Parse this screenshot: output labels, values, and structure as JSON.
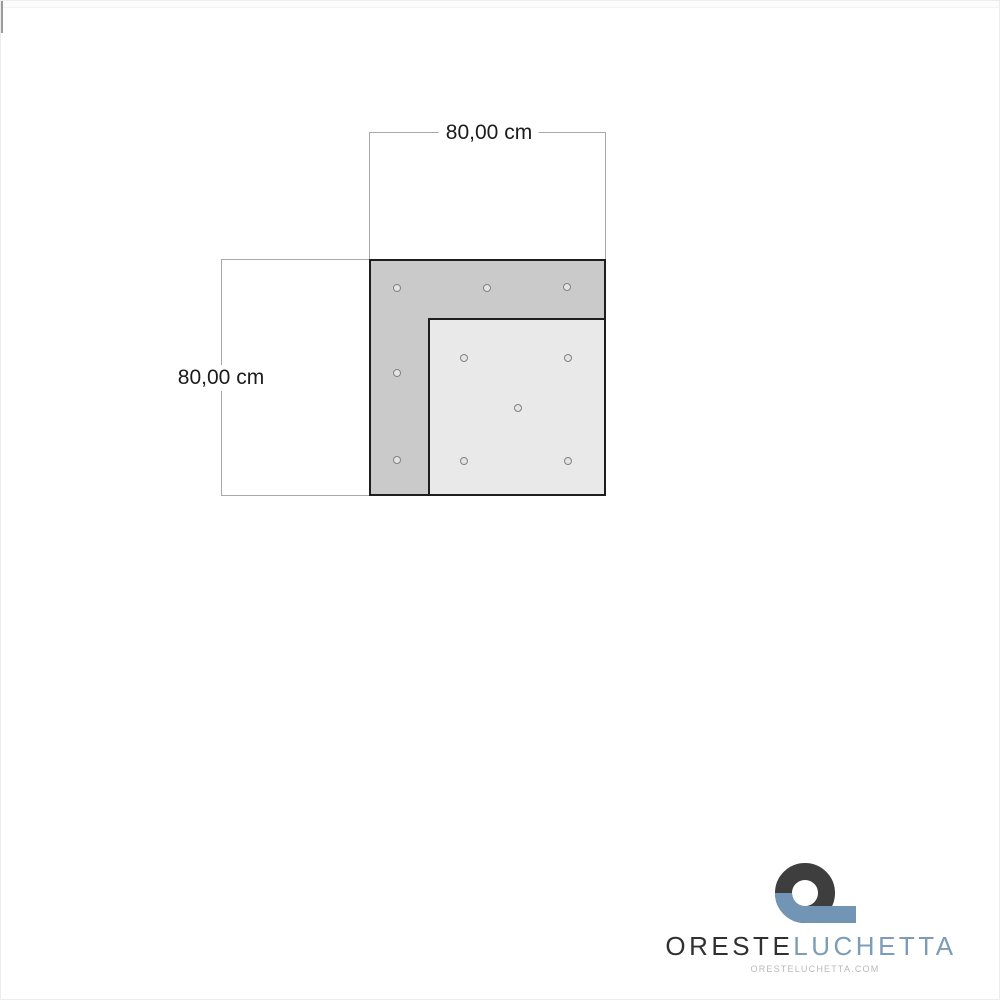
{
  "diagram": {
    "type": "product-dimension-drawing",
    "width_label": "80,00 cm",
    "height_label": "80,00 cm",
    "panel": {
      "shape": "corner-panel (dark L-shaped outer piece with lighter inset square)",
      "outer_size_cm": 80,
      "inner_size_cm": 60,
      "holes": [
        {
          "x": 396,
          "y": 287,
          "area": "outer-top-strip"
        },
        {
          "x": 486,
          "y": 287,
          "area": "outer-top-strip"
        },
        {
          "x": 566,
          "y": 286,
          "area": "outer-top-strip"
        },
        {
          "x": 396,
          "y": 372,
          "area": "outer-left-strip"
        },
        {
          "x": 396,
          "y": 459,
          "area": "outer-left-strip"
        },
        {
          "x": 463,
          "y": 357,
          "area": "inner-square"
        },
        {
          "x": 567,
          "y": 357,
          "area": "inner-square"
        },
        {
          "x": 517,
          "y": 407,
          "area": "inner-square"
        },
        {
          "x": 463,
          "y": 460,
          "area": "inner-square"
        },
        {
          "x": 567,
          "y": 460,
          "area": "inner-square"
        }
      ]
    }
  },
  "brand": {
    "primary": "ORESTE",
    "secondary": "LUCHETTA",
    "domain": "ORESTELUCHETTA.COM"
  },
  "colors": {
    "panel-dark": "#cacaca",
    "panel-light": "#e9e9e9",
    "panel-outline": "#1e1e1e",
    "dim-line": "#a8a8a8",
    "dim-text": "#1b1b1b",
    "brand-dark": "#303030",
    "brand-blue": "#7c9dba",
    "mark-dark": "#3e3e3e",
    "mark-blue": "#7295b6",
    "domain-gray": "#b6b9bb"
  }
}
